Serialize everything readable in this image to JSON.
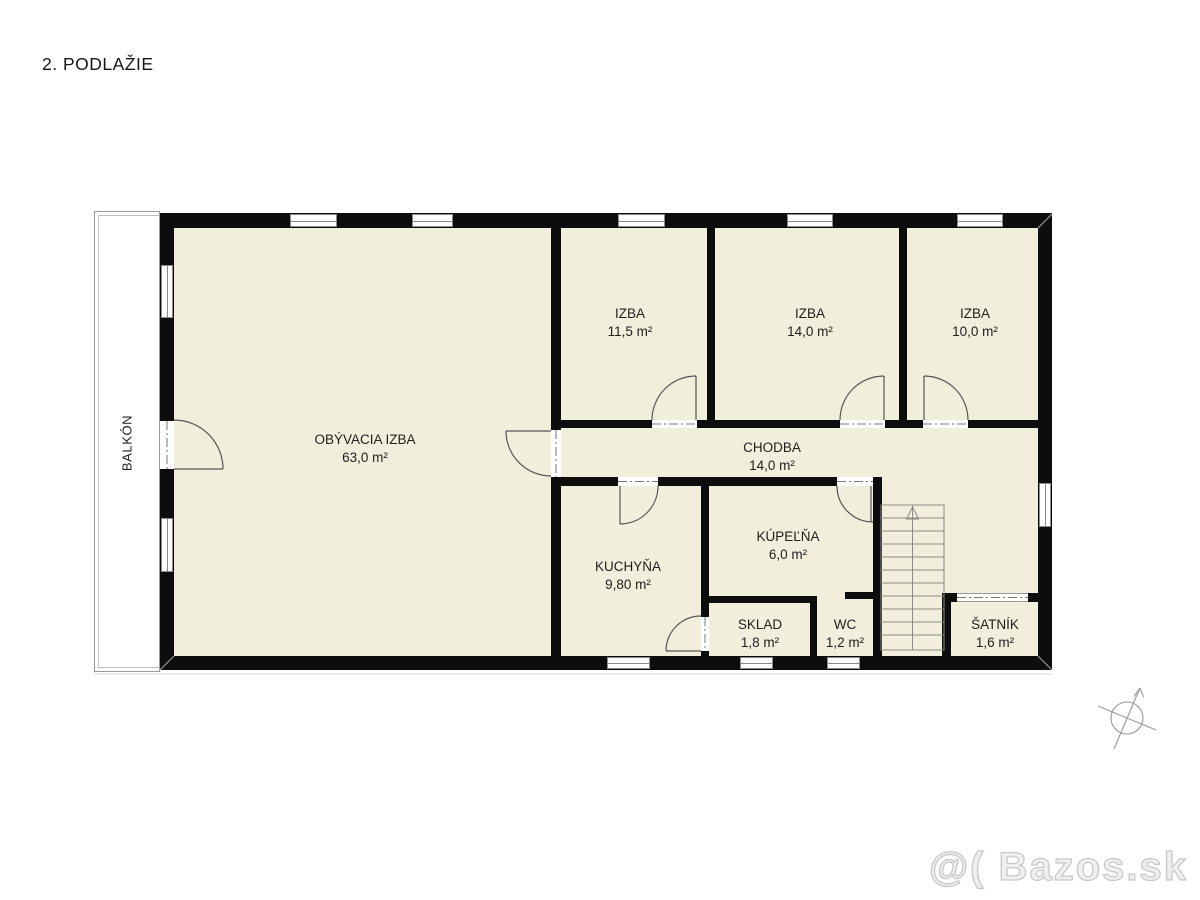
{
  "title": "2. PODLAŽIE",
  "floorplan": {
    "balcony_label": "BALKÓN",
    "rooms": [
      {
        "name": "OBÝVACIA IZBA",
        "area": "63,0 m²"
      },
      {
        "name": "IZBA",
        "area": "11,5 m²"
      },
      {
        "name": "IZBA",
        "area": "14,0 m²"
      },
      {
        "name": "IZBA",
        "area": "10,0 m²"
      },
      {
        "name": "CHODBA",
        "area": "14,0 m²"
      },
      {
        "name": "KUCHYŇA",
        "area": "9,80 m²"
      },
      {
        "name": "KÚPEĽŇA",
        "area": "6,0 m²"
      },
      {
        "name": "SKLAD",
        "area": "1,8 m²"
      },
      {
        "name": "WC",
        "area": "1,2 m²"
      },
      {
        "name": "ŠATNÍK",
        "area": "1,6 m²"
      }
    ]
  },
  "watermark": "@( Bazos.sk",
  "colors": {
    "wall": "#0d0d0d",
    "room_fill": "#f2eedc",
    "plan_lines": "#555555",
    "watermark": "#c9c9c9"
  }
}
